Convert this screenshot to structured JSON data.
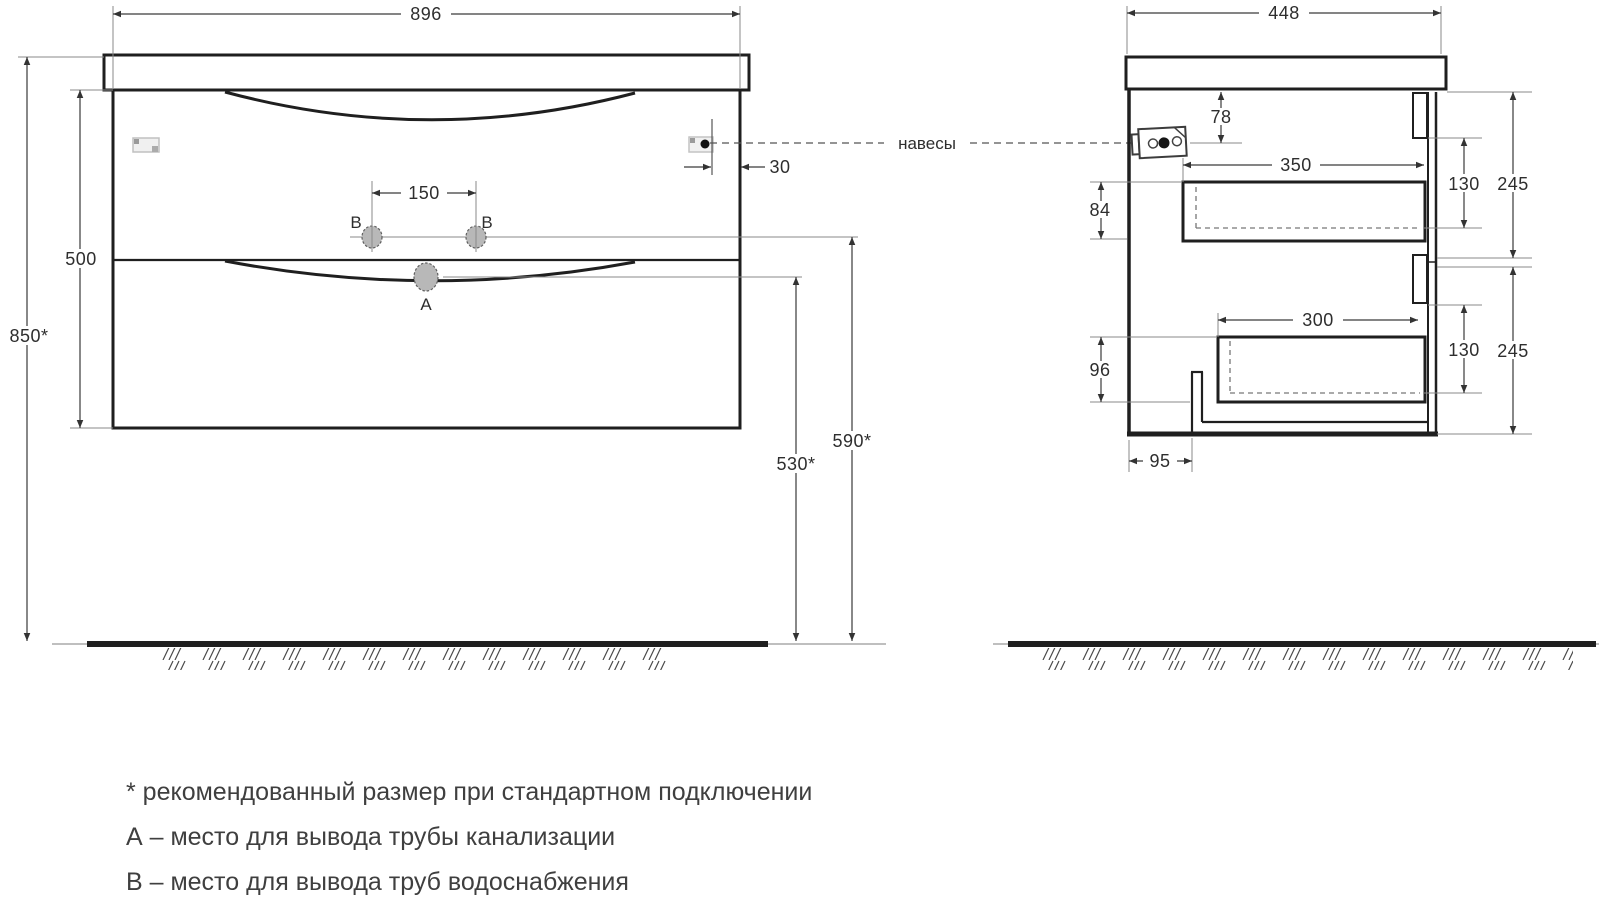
{
  "drawing": {
    "hanger_label": "навесы",
    "front": {
      "width": "896",
      "total_height": "850*",
      "body_height": "500",
      "faucet_spacing": "150",
      "hanger_offset": "30",
      "supply_height": "590*",
      "drain_height": "530*",
      "label_a": "A",
      "label_b": "B"
    },
    "side": {
      "depth": "448",
      "hanger_drop": "78",
      "drawer1_depth": "350",
      "drawer1_height": "84",
      "drawer1_front": "130",
      "section1_height": "245",
      "drawer2_depth": "300",
      "drawer2_height": "96",
      "drawer2_front": "130",
      "section2_height": "245",
      "plinth_offset": "95"
    },
    "notes": [
      "* рекомендованный размер при стандартном подключении",
      "А – место для вывода трубы канализации",
      "В – место для вывода труб водоснабжения"
    ],
    "colors": {
      "line": "#1f1f1f",
      "thin": "#8a8a8a",
      "hole_fill": "#b8b8b8",
      "text": "#3f3f3f"
    }
  }
}
